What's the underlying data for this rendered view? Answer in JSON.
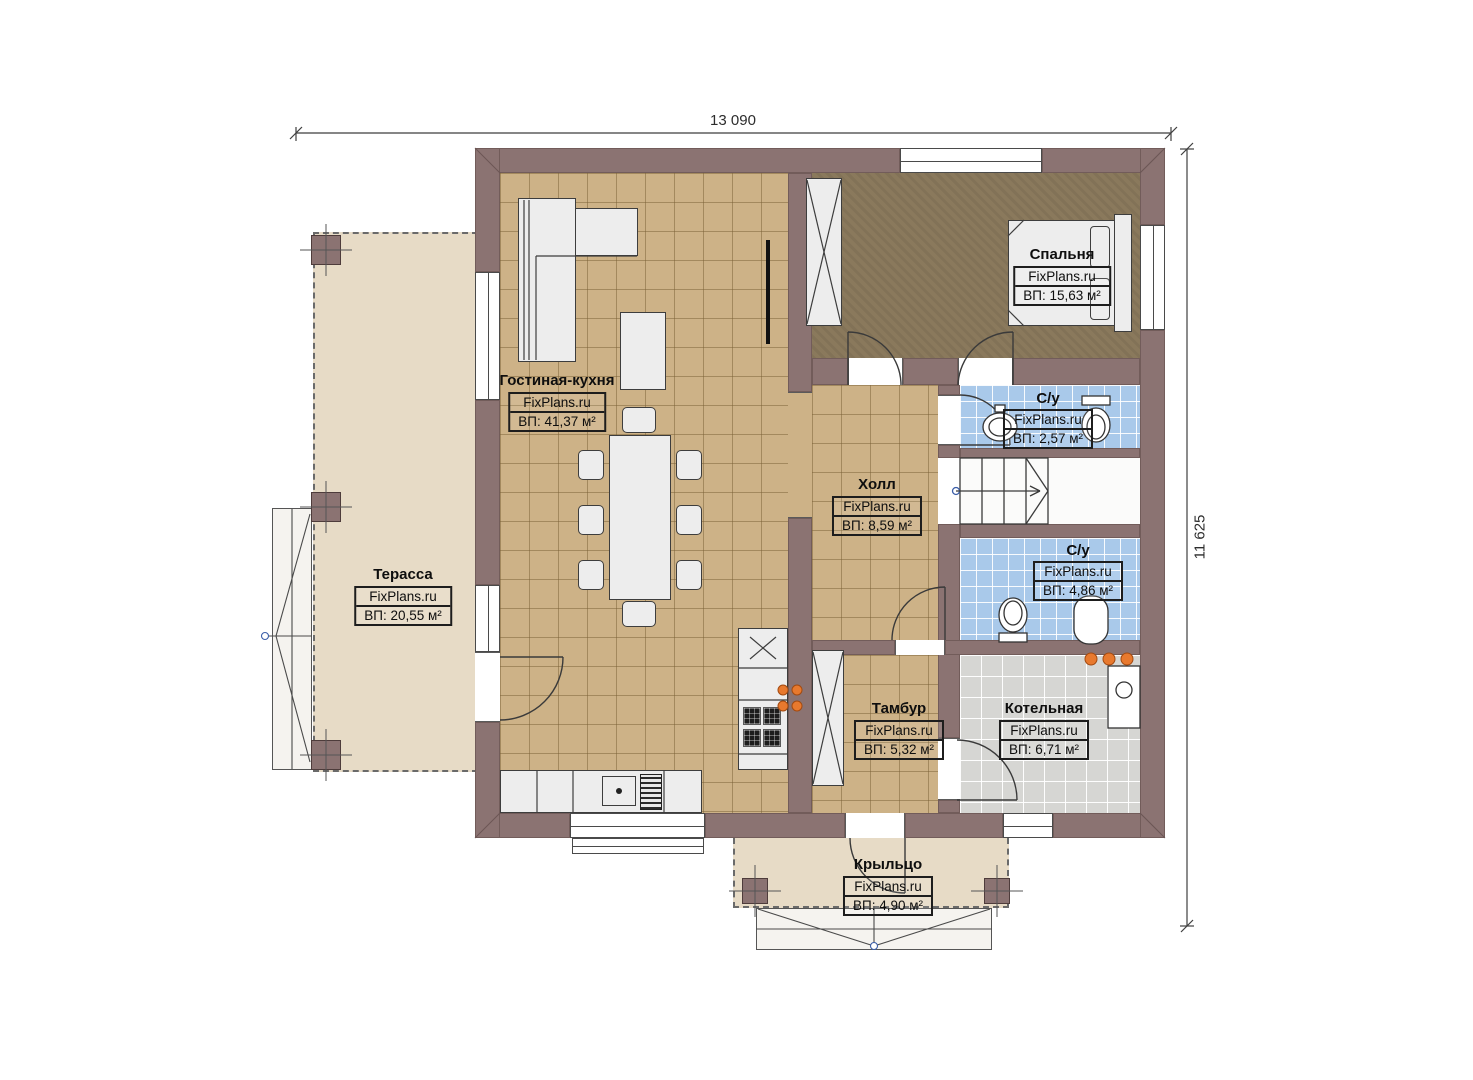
{
  "watermark": "FixPlans.ru",
  "dimensions": {
    "width": "13 090",
    "height": "11 625"
  },
  "rooms": [
    {
      "key": "living",
      "name": "Гостиная-кухня",
      "watermark": "FixPlans.ru",
      "area": "ВП: 41,37 м²"
    },
    {
      "key": "bedroom",
      "name": "Спальня",
      "watermark": "FixPlans.ru",
      "area": "ВП: 15,63 м²"
    },
    {
      "key": "hall",
      "name": "Холл",
      "watermark": "FixPlans.ru",
      "area": "ВП: 8,59 м²"
    },
    {
      "key": "wc-top",
      "name": "С/у",
      "watermark": "FixPlans.ru",
      "area": "ВП: 2,57 м²"
    },
    {
      "key": "wc-bottom",
      "name": "С/у",
      "watermark": "FixPlans.ru",
      "area": "ВП: 4,86 м²"
    },
    {
      "key": "tambour",
      "name": "Тамбур",
      "watermark": "FixPlans.ru",
      "area": "ВП: 5,32 м²"
    },
    {
      "key": "boiler",
      "name": "Котельная",
      "watermark": "FixPlans.ru",
      "area": "ВП: 6,71 м²"
    },
    {
      "key": "terrace",
      "name": "Терасса",
      "watermark": "FixPlans.ru",
      "area": "ВП: 20,55 м²"
    },
    {
      "key": "porch",
      "name": "Крыльцо",
      "watermark": "FixPlans.ru",
      "area": "ВП: 4,90 м²"
    }
  ],
  "colors": {
    "wall": "#8b7372",
    "floor_tan": "#cdb287",
    "floor_blue": "#a9c9ea",
    "floor_gray": "#d6d6d3",
    "floor_bedroom": "#8a795c",
    "floor_outdoor": "#e7dbc6",
    "radiator_orange": "#e8792e"
  }
}
